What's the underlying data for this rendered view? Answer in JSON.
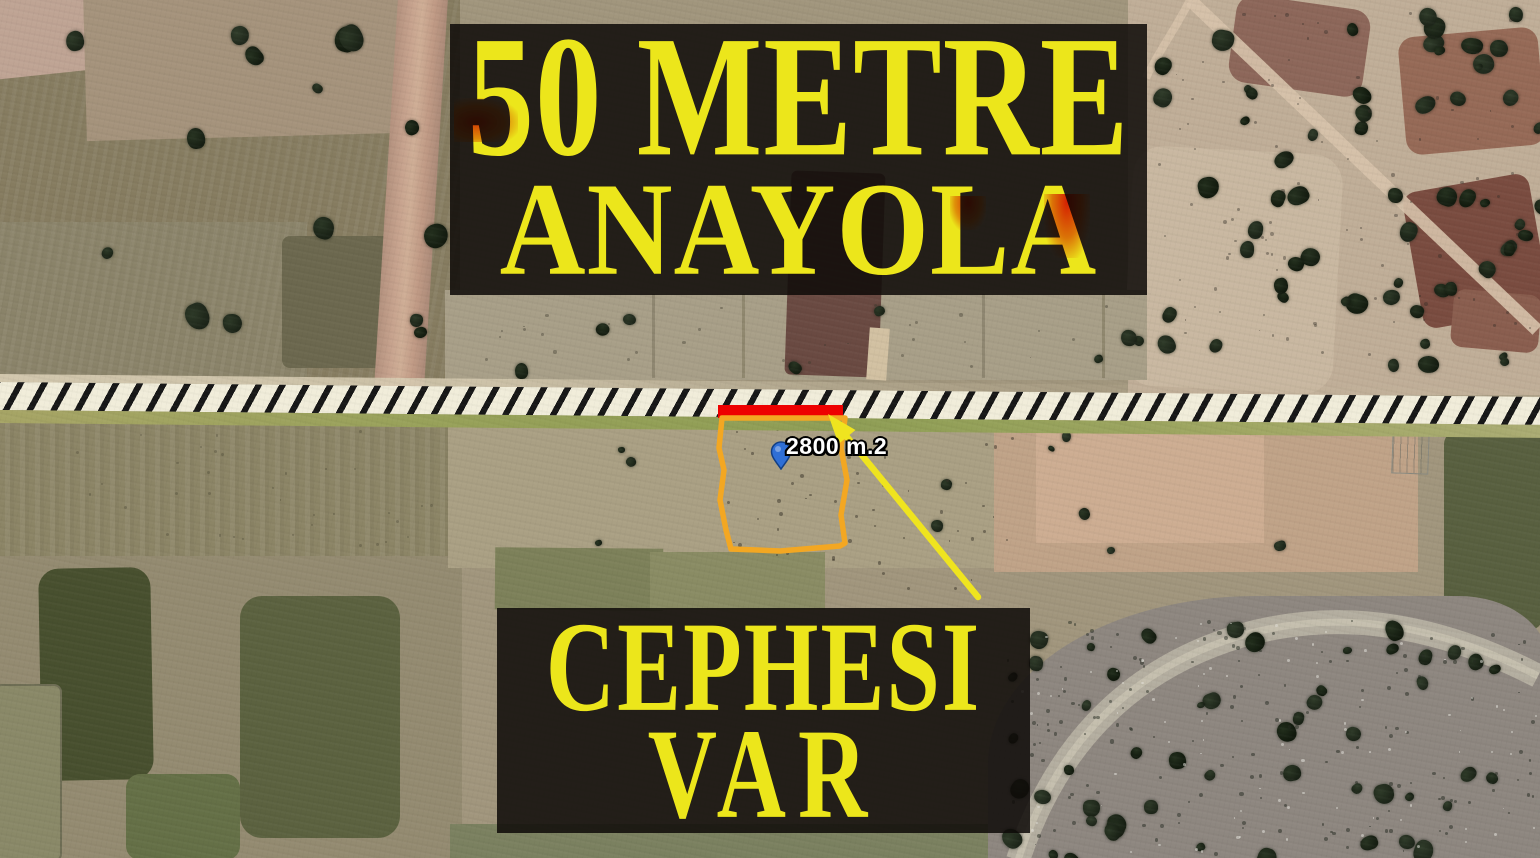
{
  "banners": {
    "top": {
      "line1": "50 METRE",
      "line2": "ANAYOLA"
    },
    "bottom": {
      "line1": "CEPHESI",
      "line2": "VAR"
    }
  },
  "parcel": {
    "area_label": "2800 m.2"
  },
  "colors": {
    "banner_text": "#ece61b",
    "banner_bg": "rgba(14,11,8,0.86)",
    "parcel_outline": "#f3a722",
    "frontage_bar": "#ee0000",
    "arrow": "#efe41f",
    "pin": "#2f6fd6",
    "road_hatch_bg": "#f1edda",
    "road_hatch_stripe": "#171717"
  }
}
